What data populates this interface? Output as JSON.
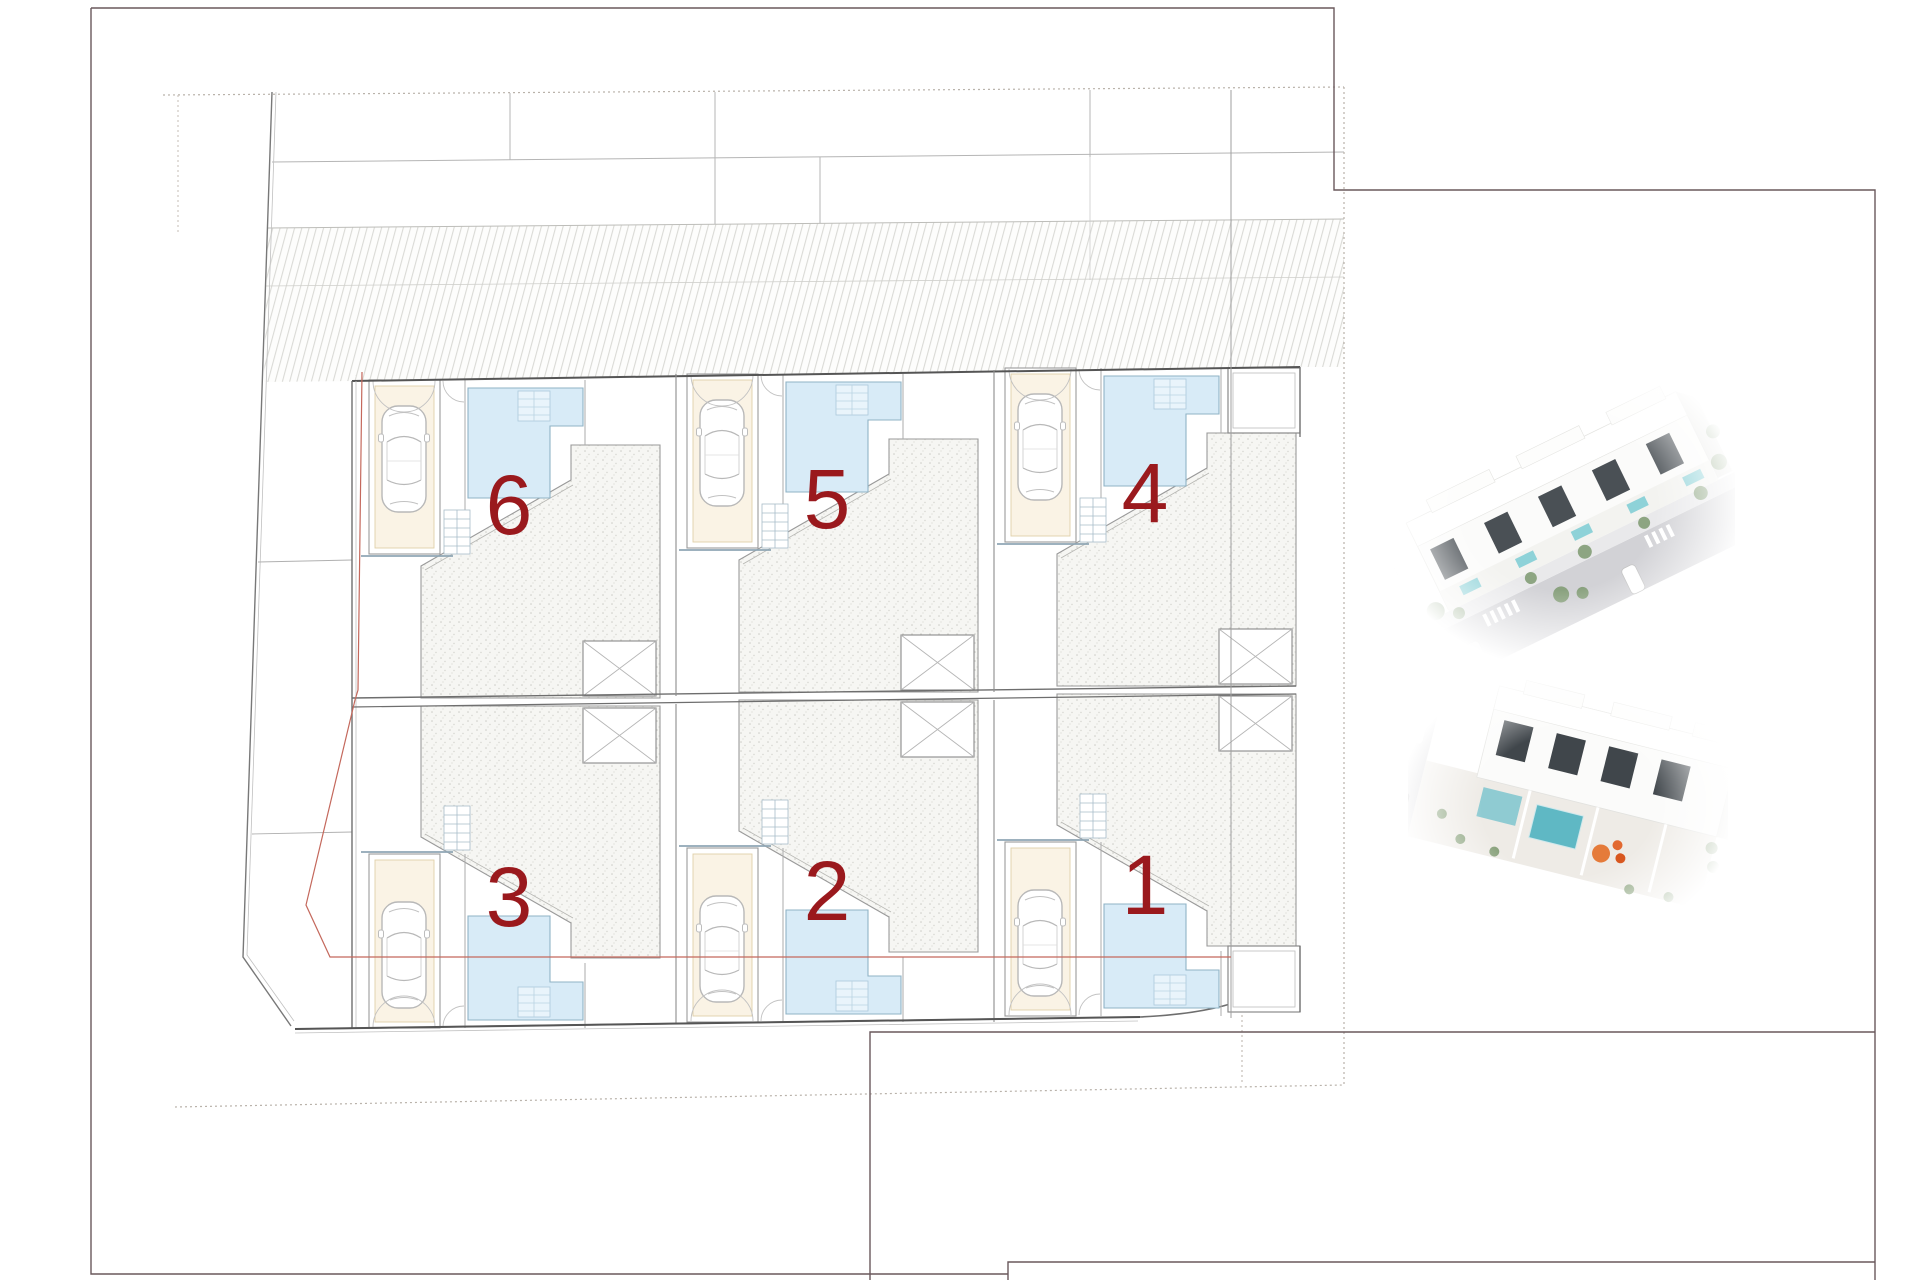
{
  "plan": {
    "units": [
      {
        "label": "6"
      },
      {
        "label": "5"
      },
      {
        "label": "4"
      },
      {
        "label": "3"
      },
      {
        "label": "2"
      },
      {
        "label": "1"
      }
    ],
    "colors": {
      "unit_number": "#9a191d",
      "pool_fill": "#d8ebf7",
      "pool_edge": "#8fb3c6",
      "pool_steps": "#e9f4fb",
      "terrace_fill": "#f6f6f3",
      "wall": "#5f5f5f",
      "light_wall": "#a8a8a8",
      "hatch_line": "#dadad6",
      "garage_pad": "#faf3e5",
      "garage_edge": "#e0d0a8",
      "teal_edge": "#8fa6b4",
      "boundary_red": "#c4685c",
      "frame": "#6a585c",
      "render_pool": "#6fc0c4",
      "render_accent": "#e2682f",
      "render_green": "#7e9a70",
      "render_road": "#d2d2d6"
    }
  }
}
